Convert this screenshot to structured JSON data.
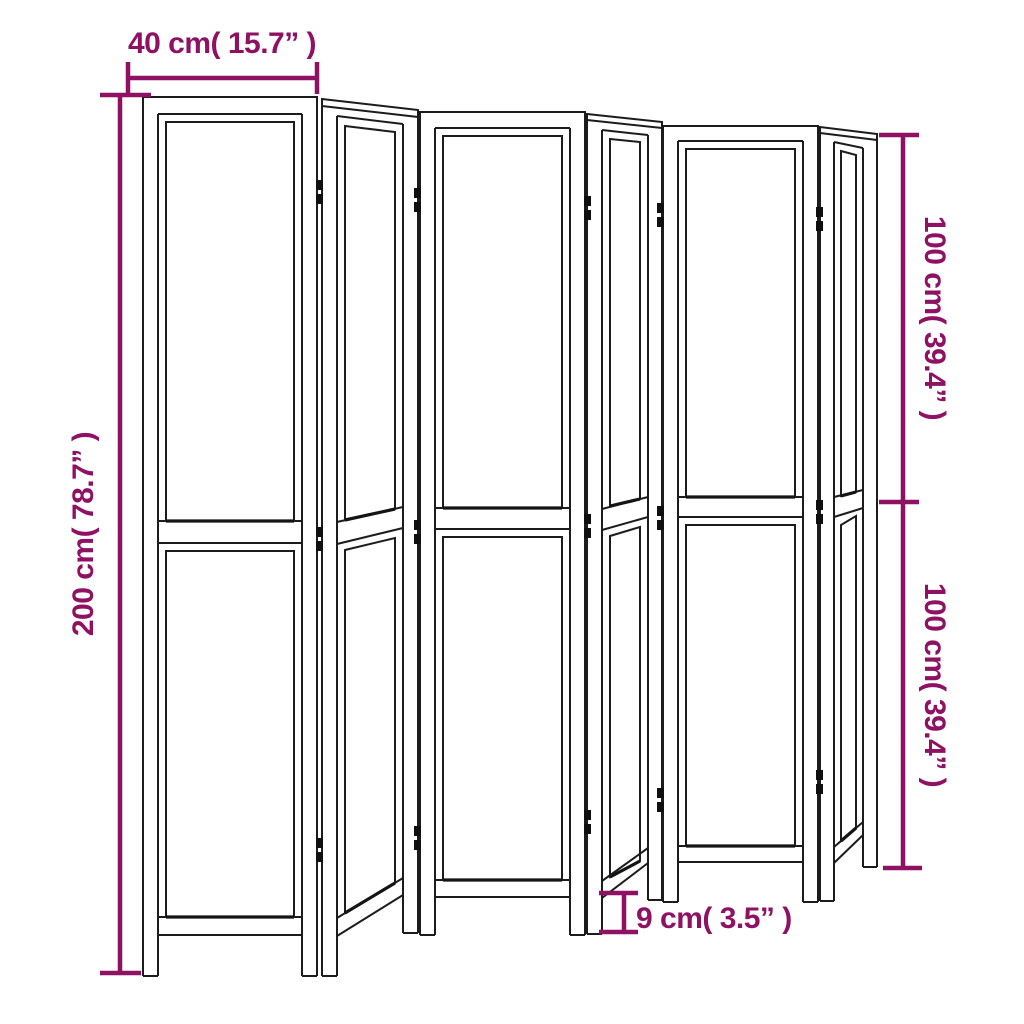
{
  "diagram": {
    "type": "product-dimension-diagram",
    "subject": "folding room divider",
    "panel_count": 6,
    "colors": {
      "dimension": "#8E1164",
      "line_art": "#1c1c1c",
      "background": "#ffffff"
    },
    "labels": {
      "top_width": "40 cm( 15.7” )",
      "left_height": "200 cm( 78.7” )",
      "right_upper_height": "100 cm( 39.4” )",
      "right_lower_height": "100 cm( 39.4” )",
      "bottom_leg_height": "9 cm( 3.5” )"
    }
  }
}
